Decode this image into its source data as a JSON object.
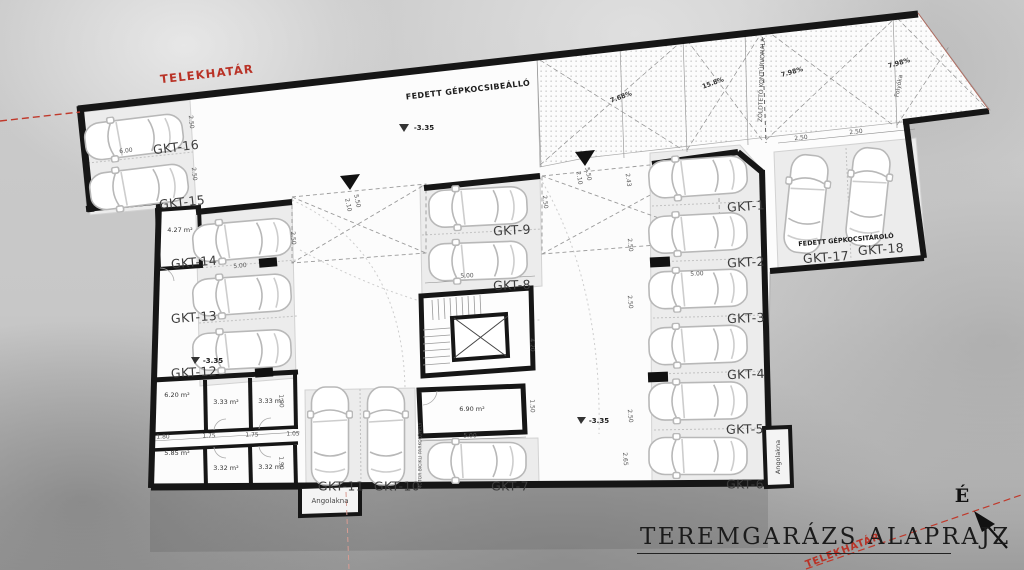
{
  "title": {
    "text": "TEREMGARÁZS ALAPRAJZ"
  },
  "north": {
    "label": "É"
  },
  "boundary": {
    "top": "TELEKHATÁR",
    "bottom": "TELEKHATÁR"
  },
  "zones": {
    "carport": "FEDETT GÉPKOCSIBEÁLLÓ",
    "garage_storage": "FEDETT GÉPKOCSITÁROLÓ",
    "green_roof": "ZÖLDTETŐ KONTÚRVONALA",
    "drain": "Folyóka",
    "moto_parking": "MOTOR BICIKLI PARKOLÓHELY",
    "light_well_bottom": "Angolakna",
    "light_well_right": "Angolakna"
  },
  "levels": [
    "-3.35",
    "-3.35",
    "-3.35"
  ],
  "slopes": [
    "7.68%",
    "15.8%",
    "7.98%",
    "7.98%"
  ],
  "parking": [
    "GKT-1",
    "GKT-2",
    "GKT-3",
    "GKT-4",
    "GKT-5",
    "GKT-6",
    "GKT-7",
    "GKT-8",
    "GKT-9",
    "GKT-10",
    "GKT-11",
    "GKT-12",
    "GKT-13",
    "GKT-14",
    "GKT-15",
    "GKT-16",
    "GKT-17",
    "GKT-18"
  ],
  "rooms": [
    "4.27 m²",
    "6.20 m²",
    "3.33 m²",
    "3.33 m²",
    "5.85 m²",
    "3.32 m²",
    "3.32 m²",
    "6.90 m²"
  ],
  "dims": [
    "6.00",
    "2.50",
    "2.50",
    "5.00",
    "2.50",
    "5.50",
    "2.10",
    "5.50",
    "2.10",
    "2.43",
    "2.50",
    "2.50",
    "2.50",
    "5.00",
    "5.00",
    "5.00",
    "4.20",
    "1.50",
    "2.65",
    "1.80",
    "1.75",
    "1.75",
    "1.05",
    "1.90",
    "1.90",
    "2.50",
    "2.50",
    "2.50"
  ],
  "colors": {
    "boundary_red": "#b93226",
    "wall": "#161616",
    "paper": "#fcfcfc"
  }
}
